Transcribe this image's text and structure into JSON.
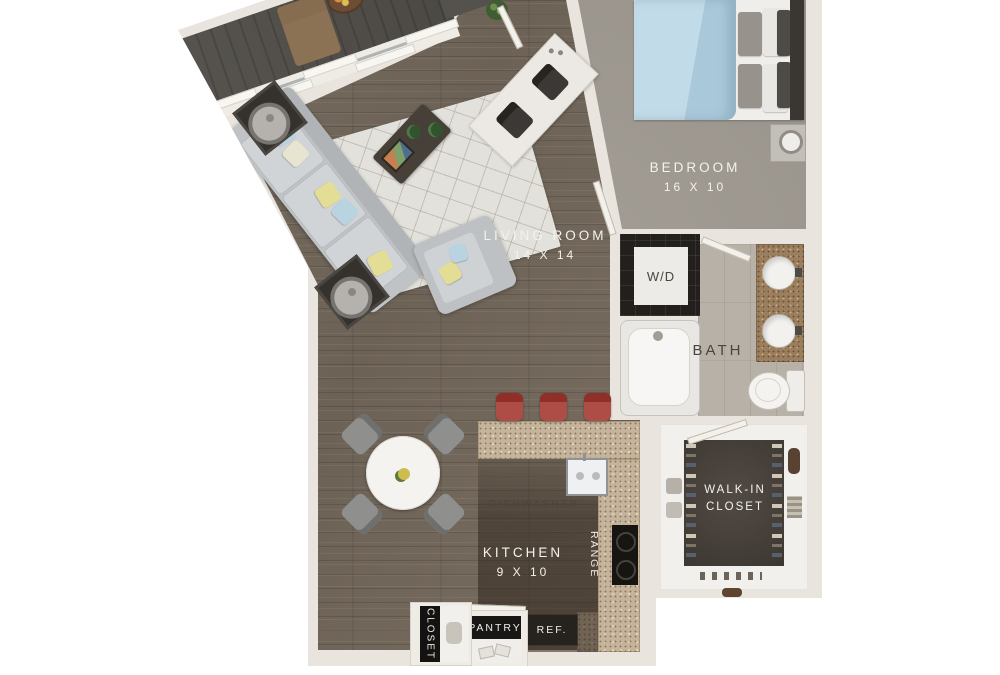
{
  "plan": {
    "rooms": {
      "living_room": {
        "label": "LIVING ROOM",
        "dims": "14 X 14"
      },
      "bedroom": {
        "label": "BEDROOM",
        "dims": "16 X 10"
      },
      "kitchen": {
        "label": "KITCHEN",
        "dims": "9 X 10"
      },
      "bath": {
        "label": "BATH"
      },
      "walk_in_closet": {
        "line1": "WALK-IN",
        "line2": "CLOSET"
      },
      "laundry": {
        "label": "W/D"
      }
    },
    "fixtures": {
      "dishwasher": "DISHWASHER",
      "range": "RANGE",
      "refrigerator": "REF.",
      "pantry": "PANTRY",
      "entry_closet": "CLOSET"
    },
    "colors": {
      "wall": "#e9e5de",
      "hardwood": "#746a5e",
      "bedroom_carpet": "#9d978e",
      "balcony_floor": "#53504b",
      "bath_tile": "#b7b1a8",
      "walkin_floor": "#48413a",
      "counter_granite": "#c5b49b",
      "vanity_granite": "#9a7e5e",
      "appliance_dark": "#26231f",
      "stool_red": "#a7423a",
      "bedding_blue": "#b6d3e3"
    }
  }
}
